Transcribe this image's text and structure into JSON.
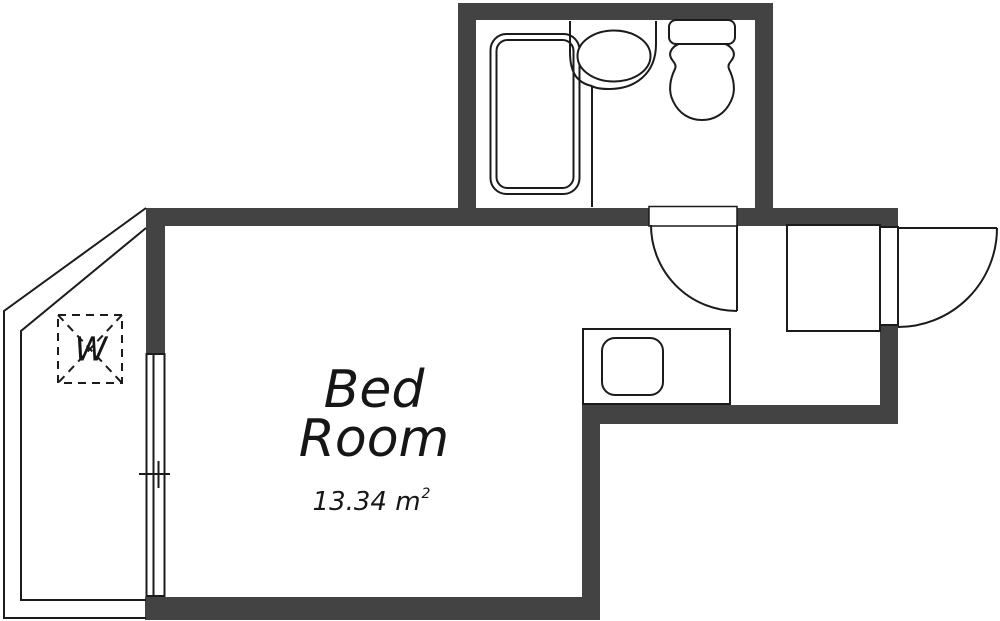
{
  "colors": {
    "wall": "#434343",
    "line": "#1b1b1b",
    "background": "#ffffff",
    "text": "#161616"
  },
  "rooms": {
    "bedroom": {
      "label": [
        "Bed",
        "Room"
      ],
      "area": "13.34 m",
      "area_sup": "2"
    },
    "balcony": {
      "washer_label": "W"
    }
  }
}
